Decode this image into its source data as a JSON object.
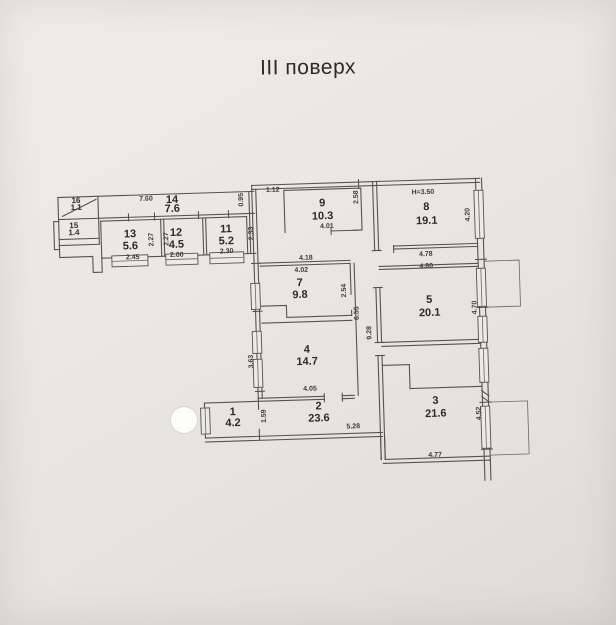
{
  "title": "III поверх",
  "colors": {
    "paper": "#e9e7e3",
    "line": "#56534e",
    "text": "#2c2a27"
  },
  "floor_plan": {
    "rooms": [
      {
        "number": "16",
        "area": "1.1",
        "x": 80,
        "y": 196,
        "dy": 7,
        "small": true
      },
      {
        "number": "15",
        "area": "1.4",
        "x": 77,
        "y": 221,
        "dy": 7,
        "small": true
      },
      {
        "number": "14",
        "area": "7.6",
        "x": 176,
        "y": 199,
        "dy": 9
      },
      {
        "number": "13",
        "area": "5.6",
        "x": 133,
        "y": 232,
        "dy": 12
      },
      {
        "number": "12",
        "area": "4.5",
        "x": 179,
        "y": 232,
        "dy": 12
      },
      {
        "number": "11",
        "area": "5.2",
        "x": 229,
        "y": 230,
        "dy": 12
      },
      {
        "number": "9",
        "area": "10.3",
        "x": 326,
        "y": 207,
        "dy": 13
      },
      {
        "number": "8",
        "area": "19.1",
        "x": 430,
        "y": 214,
        "dy": 14
      },
      {
        "number": "7",
        "area": "9.8",
        "x": 301,
        "y": 286,
        "dy": 12
      },
      {
        "number": "5",
        "area": "20.1",
        "x": 430,
        "y": 307,
        "dy": 13
      },
      {
        "number": "4",
        "area": "14.7",
        "x": 306,
        "y": 353,
        "dy": 12
      },
      {
        "number": "2",
        "area": "23.6",
        "x": 316,
        "y": 410,
        "dy": 12
      },
      {
        "number": "1",
        "area": "4.2",
        "x": 230,
        "y": 413,
        "dy": 11
      },
      {
        "number": "3",
        "area": "21.6",
        "x": 433,
        "y": 408,
        "dy": 13
      }
    ],
    "dimensions": [
      {
        "t": "7.60",
        "x": 150,
        "y": 196
      },
      {
        "t": "0.95",
        "x": 247,
        "y": 198,
        "r": -90
      },
      {
        "t": "1.12",
        "x": 277,
        "y": 191
      },
      {
        "t": "2.58",
        "x": 362,
        "y": 199,
        "r": -90
      },
      {
        "t": "H=3.50",
        "x": 427,
        "y": 198
      },
      {
        "t": "4.20",
        "x": 473,
        "y": 220,
        "r": -90
      },
      {
        "t": "2.27",
        "x": 156,
        "y": 235,
        "r": -90
      },
      {
        "t": "2.27",
        "x": 171,
        "y": 235,
        "r": -90
      },
      {
        "t": "2.33",
        "x": 256,
        "y": 232,
        "r": -90
      },
      {
        "t": "2.45",
        "x": 135,
        "y": 254
      },
      {
        "t": "2.00",
        "x": 179,
        "y": 253
      },
      {
        "t": "2.30",
        "x": 229,
        "y": 251
      },
      {
        "t": "4.01",
        "x": 330,
        "y": 229
      },
      {
        "t": "4.78",
        "x": 428,
        "y": 260
      },
      {
        "t": "4.18",
        "x": 308,
        "y": 260
      },
      {
        "t": "4.02",
        "x": 303,
        "y": 272
      },
      {
        "t": "4.80",
        "x": 428,
        "y": 272
      },
      {
        "t": "2.54",
        "x": 347,
        "y": 292,
        "r": -90
      },
      {
        "t": "4.70",
        "x": 477,
        "y": 313,
        "r": -90
      },
      {
        "t": "6.55",
        "x": 359,
        "y": 315,
        "r": -90
      },
      {
        "t": "9.28",
        "x": 371,
        "y": 335,
        "r": -90
      },
      {
        "t": "3.63",
        "x": 252,
        "y": 360,
        "r": -90
      },
      {
        "t": "4.05",
        "x": 308,
        "y": 391
      },
      {
        "t": "1.59",
        "x": 263,
        "y": 415,
        "r": -90
      },
      {
        "t": "5.28",
        "x": 350,
        "y": 430
      },
      {
        "t": "4.52",
        "x": 478,
        "y": 419,
        "r": -90
      },
      {
        "t": "4.77",
        "x": 431,
        "y": 461
      }
    ]
  }
}
